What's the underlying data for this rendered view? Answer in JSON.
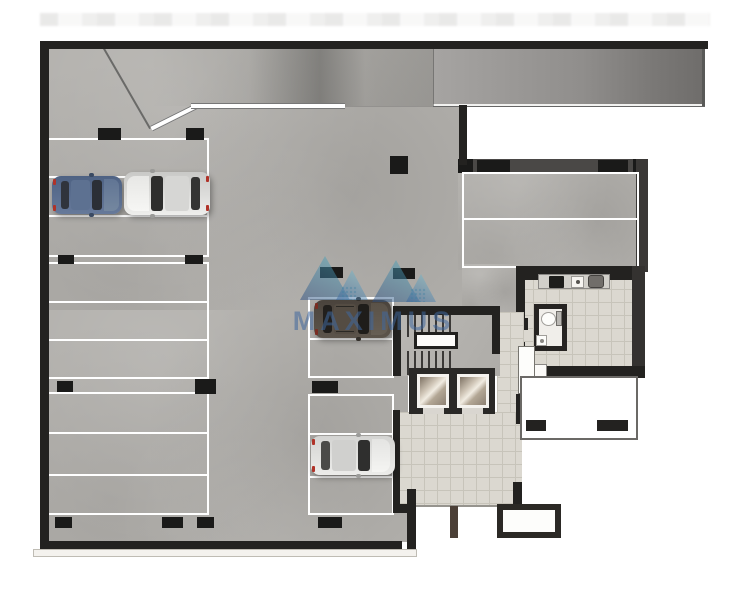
{
  "title": "Basement parking garage floor plan",
  "watermark": {
    "text": "MAXIMUS",
    "logo": "twin-mountain-triangles",
    "colors": {
      "deep_blue": "#2a4a7e",
      "teal": "#55b3c4",
      "text_blue": "#40689e"
    }
  },
  "palette": {
    "wall": "#232220",
    "concrete_floor": "#b1afab",
    "tile_floor": "#dbd8d0",
    "parking_stripe": "#ffffff",
    "ramp": "#8e8c8a",
    "elevator_cab": "#cfc5b6",
    "background": "#ffffff"
  },
  "parking": {
    "left_column_groups": 3,
    "left_column_spaces_per_group": 3,
    "middle_column_spaces": 5,
    "right_block_spaces": 2,
    "columns_note": "black structural columns between parking groups"
  },
  "cars": [
    {
      "color_hex": "#5b6e8b",
      "description": "blue hatchback",
      "location": "left column, second row, facing right"
    },
    {
      "color_hex": "#dadad8",
      "description": "silver SUV",
      "location": "left column, second row, facing left"
    },
    {
      "color_hex": "#514a42",
      "description": "dark brown SUV",
      "location": "middle column, top space"
    },
    {
      "color_hex": "#e0e0de",
      "description": "white crossover",
      "location": "middle column, lower space"
    }
  ],
  "rooms": {
    "stairwell": "dog-leg stair with mid landing",
    "elevators": 2,
    "lobby": "tiled elevator lobby",
    "kitchenette": [
      "counter",
      "stove",
      "sink",
      "refrigerator"
    ],
    "bathroom": [
      "toilet",
      "hand-basin"
    ]
  },
  "ramp": "entry ramp along top edge with white curb stripe"
}
